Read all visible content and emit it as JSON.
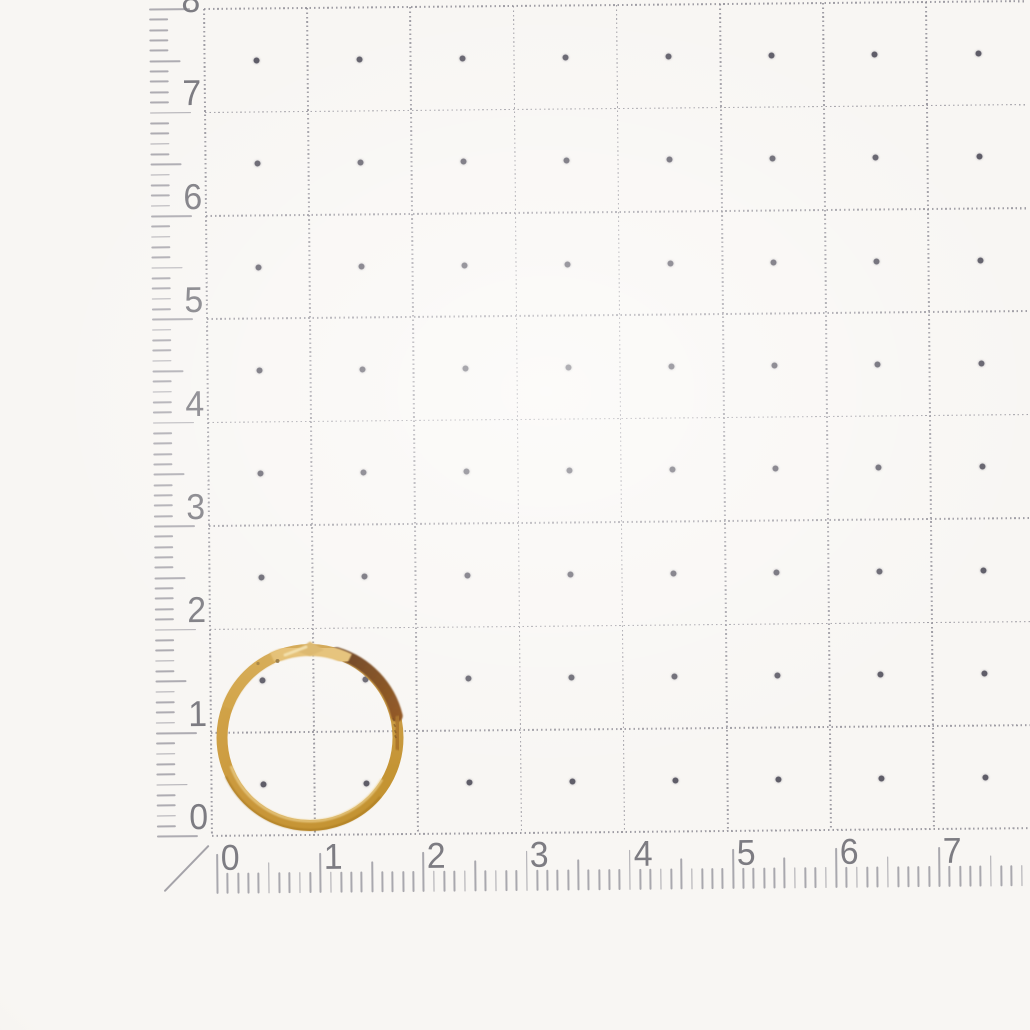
{
  "scene": {
    "subject": "gold hoop ring lying on millimeter grid measuring paper",
    "ring": {
      "outer_diameter_cm": 1.85,
      "center_x_cm": 0.95,
      "center_y_cm": 0.95
    }
  },
  "grid": {
    "rows": 8,
    "cols": 8,
    "has_center_dots": true
  },
  "vertical_ruler": {
    "labels": [
      "8",
      "7",
      "6",
      "5",
      "4",
      "3",
      "2",
      "1",
      "0"
    ]
  },
  "horizontal_ruler": {
    "labels": [
      "0",
      "1",
      "2",
      "3",
      "4",
      "5",
      "6",
      "7"
    ]
  },
  "colors": {
    "paper": "#f8f6f3",
    "grid_line": "#8f8d96",
    "grid_dot": "#5f5d68",
    "ruler_tick": "#9b9aa1",
    "ruler_number": "#7d7c82",
    "gold_base": "#c9973b",
    "gold_light": "#d4a84e",
    "gold_deep": "#c2922f",
    "gold_highlight": "#eed391",
    "gold_dark": "#5e2f07",
    "gold_dark_edge": "#8a4d14",
    "gold_mid": "#a76e22",
    "gold_outer_shade": "#a5761f",
    "clasp": "#e3bc6c",
    "clasp_kink": "#d9b161",
    "clasp_highlight": "#f4e3ae",
    "hinge": "#8a6a33",
    "engraving": "#6d4214"
  }
}
